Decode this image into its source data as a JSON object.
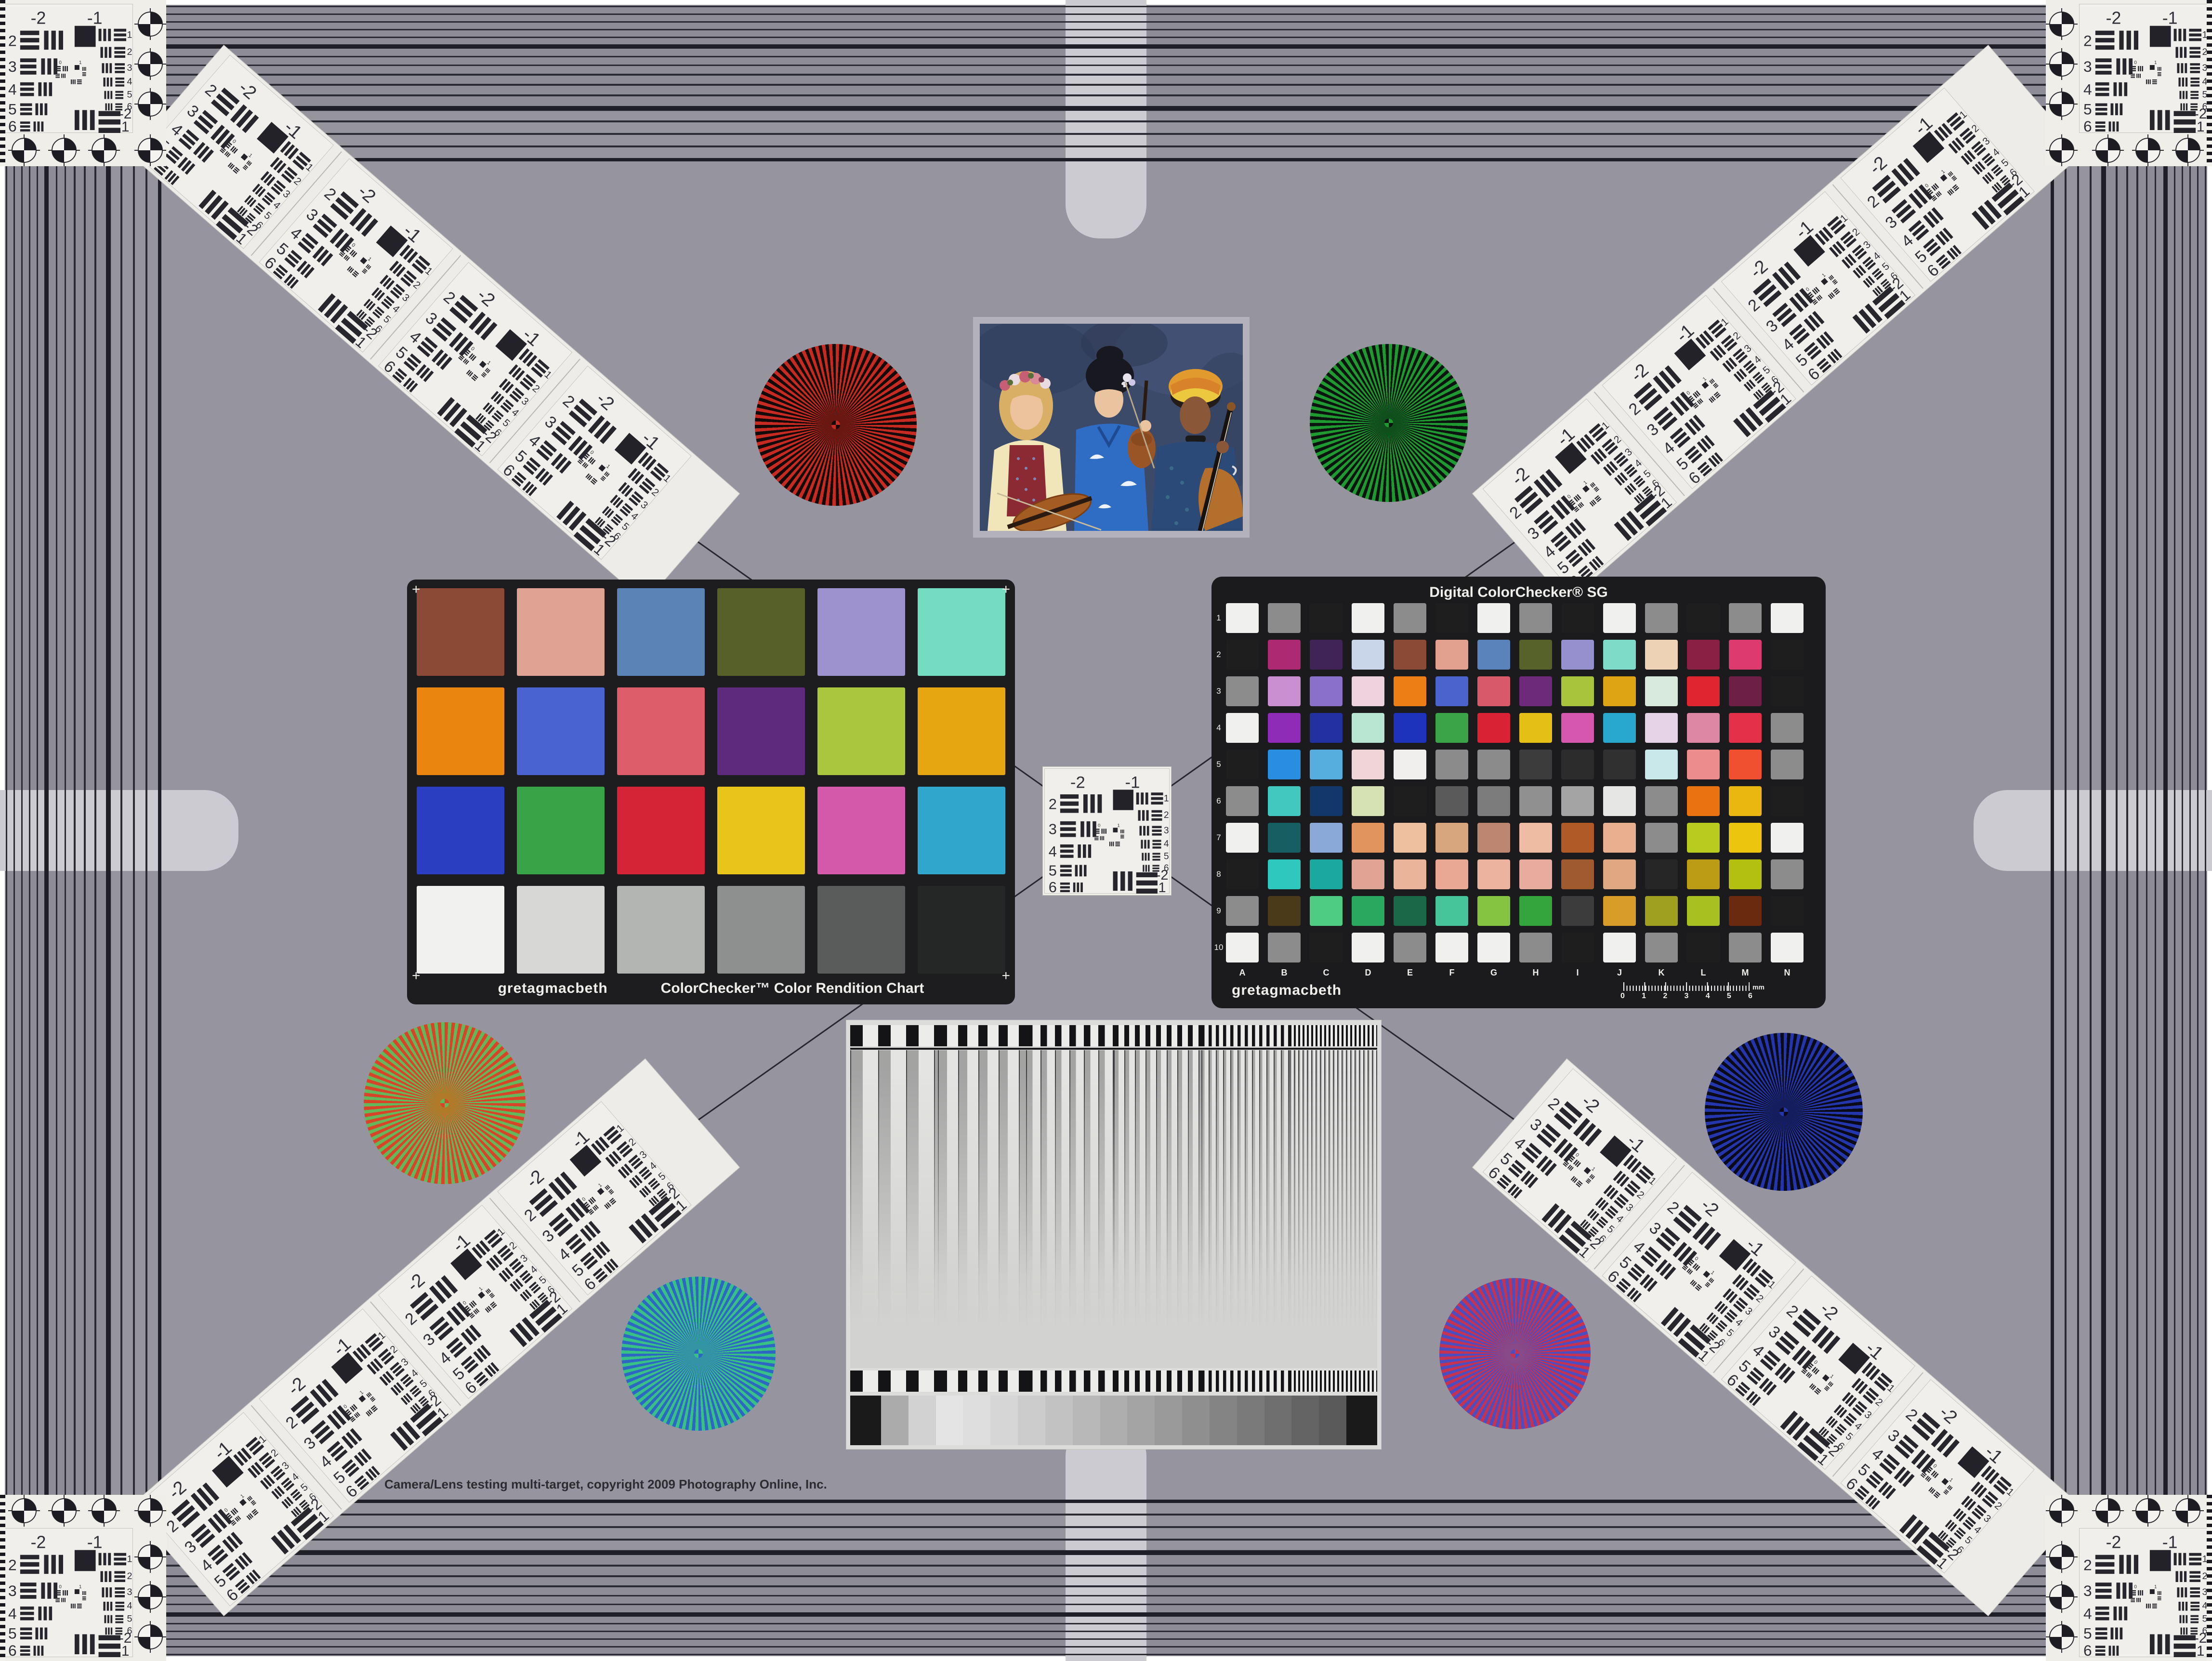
{
  "page": {
    "copyright": "Camera/Lens testing multi-target, copyright 2009 Photography Online, Inc.",
    "background_color": "#96949e",
    "frame_tab_color": "#cbcbd1"
  },
  "usaf": {
    "neg2": "-2",
    "neg1": "-1",
    "left": [
      "2",
      "3",
      "4",
      "5",
      "6"
    ],
    "right": [
      "1",
      "2",
      "3",
      "4",
      "5",
      "6"
    ],
    "bottom": [
      "-2",
      "1"
    ],
    "mini": [
      "0",
      "1"
    ]
  },
  "colorchecker24": {
    "brand": "gretagmacbeth",
    "name": "ColorChecker™ Color Rendition Chart",
    "corner_mark": "+",
    "colors": [
      [
        "#8a4a36",
        "#dfa394",
        "#5c83b6",
        "#58602a",
        "#9d92ce",
        "#73dcc1"
      ],
      [
        "#ea8610",
        "#4a64cf",
        "#dd5e6a",
        "#5d2a7e",
        "#a9c63e",
        "#e5a612"
      ],
      [
        "#2a3ec2",
        "#39a447",
        "#d52435",
        "#e7c51b",
        "#d459ab",
        "#30a6cd"
      ],
      [
        "#f1f1ef",
        "#d7d8d6",
        "#b3b5b3",
        "#8e9090",
        "#595c5b",
        "#252727"
      ]
    ]
  },
  "colorchecker_sg": {
    "title": "Digital ColorChecker® SG",
    "brand": "gretagmacbeth",
    "row_labels": [
      "1",
      "2",
      "3",
      "4",
      "5",
      "6",
      "7",
      "8",
      "9",
      "10"
    ],
    "col_labels": [
      "A",
      "B",
      "C",
      "D",
      "E",
      "F",
      "G",
      "H",
      "I",
      "J",
      "K",
      "L",
      "M",
      "N"
    ],
    "ruler_numbers": [
      "0",
      "1",
      "2",
      "3",
      "4",
      "5",
      "6"
    ],
    "ruler_unit": "mm",
    "colors": [
      [
        "#f0f0ee",
        "#8c8c8c",
        "#1e1e1e",
        "#f0f0ee",
        "#8c8c8c",
        "#1e1e1e",
        "#f0f0ee",
        "#8c8c8c",
        "#1e1e1e",
        "#f0f0ee",
        "#8c8c8c",
        "#1e1e1e",
        "#8c8c8c",
        "#f0f0ee"
      ],
      [
        "#1e1e1e",
        "#ad2a73",
        "#402458",
        "#c9d5e8",
        "#8a4a36",
        "#e2a18f",
        "#5a83bb",
        "#57612a",
        "#9790cf",
        "#7edbc8",
        "#eed2b6",
        "#8a2043",
        "#dd3a70",
        "#1e1e1e"
      ],
      [
        "#8c8c8c",
        "#ca8fd0",
        "#8a70c8",
        "#eed2de",
        "#ed7e16",
        "#4a63cd",
        "#d85a68",
        "#6e2a7a",
        "#a8c43c",
        "#dfa414",
        "#d8eade",
        "#e02531",
        "#6d1f45",
        "#1e1e1e"
      ],
      [
        "#f0f0ee",
        "#8e2cb8",
        "#2330a0",
        "#b8e6d2",
        "#1d33bb",
        "#3ba449",
        "#d92233",
        "#e4bf16",
        "#d557ae",
        "#29a8cd",
        "#e6d3e8",
        "#dd87a4",
        "#e5304a",
        "#8c8c8c"
      ],
      [
        "#1e1e1e",
        "#2a8ee0",
        "#56aede",
        "#f0d5d8",
        "#f1efed",
        "#8b8b8b",
        "#8b8b8b",
        "#3c3c3c",
        "#2c2c2c",
        "#303030",
        "#c8e8ea",
        "#ec8c8c",
        "#f05030",
        "#8c8c8c"
      ],
      [
        "#8c8c8c",
        "#43c8c0",
        "#12386a",
        "#d6e2b4",
        "#1e1e1e",
        "#5a5a5a",
        "#7c7c7c",
        "#909090",
        "#a4a4a4",
        "#e6e6e4",
        "#8c8c8c",
        "#ea7210",
        "#eab711",
        "#1e1e1e"
      ],
      [
        "#f0f0ee",
        "#175e63",
        "#8aa8d8",
        "#e2945e",
        "#eec0a0",
        "#d8a67e",
        "#bc8670",
        "#eebca2",
        "#b05a28",
        "#e8b08e",
        "#8c8c8c",
        "#b8cc20",
        "#ecc50e",
        "#f0f0ee"
      ],
      [
        "#1e1e1e",
        "#2ec8be",
        "#1ba8a0",
        "#e0a494",
        "#eab49a",
        "#e8a894",
        "#ecb49e",
        "#e8ac9e",
        "#a05a30",
        "#e0a882",
        "#262626",
        "#bc9c14",
        "#b4c010",
        "#8c8c8c"
      ],
      [
        "#8c8c8c",
        "#4a3a1a",
        "#4ecc84",
        "#2aa860",
        "#1a6848",
        "#46c49a",
        "#84c440",
        "#34a43c",
        "#3c3c3c",
        "#d89c28",
        "#a0a020",
        "#a8c020",
        "#6a2a10",
        "#1e1e1e"
      ],
      [
        "#f0f0ee",
        "#8c8c8c",
        "#1e1e1e",
        "#f0f0ee",
        "#8c8c8c",
        "#f0f0ee",
        "#f0f0ee",
        "#8c8c8c",
        "#1e1e1e",
        "#f0f0ee",
        "#8c8c8c",
        "#1e1e1e",
        "#8c8c8c",
        "#f0f0ee"
      ]
    ]
  },
  "sweep": {
    "grayscale_steps": [
      "#1a1a1a",
      "#ababab",
      "#d2d2d2",
      "#e4e4e4",
      "#dedede",
      "#d6d6d6",
      "#cccccc",
      "#c2c2c2",
      "#b8b8b8",
      "#aeaeae",
      "#a4a4a4",
      "#9a9a9a",
      "#8f8f8f",
      "#848484",
      "#7a7a7a",
      "#6f6f6f",
      "#646464",
      "#5a5a5a",
      "#1a1a1a"
    ]
  },
  "stars": [
    {
      "name": "red-black-star",
      "c1": "#c62a20",
      "c2": "#140a0a",
      "mix": "#6a1712"
    },
    {
      "name": "green-black-star",
      "c1": "#1e9a31",
      "c2": "#0c1410",
      "mix": "#0f4f1c"
    },
    {
      "name": "red-green-star",
      "c1": "#d84428",
      "c2": "#64b85c",
      "mix": "#b07a28"
    },
    {
      "name": "blue-black-star",
      "c1": "#2436ac",
      "c2": "#0a0a18",
      "mix": "#141d5e"
    },
    {
      "name": "green-blue-star",
      "c1": "#38c184",
      "c2": "#2e66c4",
      "mix": "#3394a4"
    },
    {
      "name": "red-blue-star",
      "c1": "#c53350",
      "c2": "#4a4ec0",
      "mix": "#884a88"
    }
  ]
}
